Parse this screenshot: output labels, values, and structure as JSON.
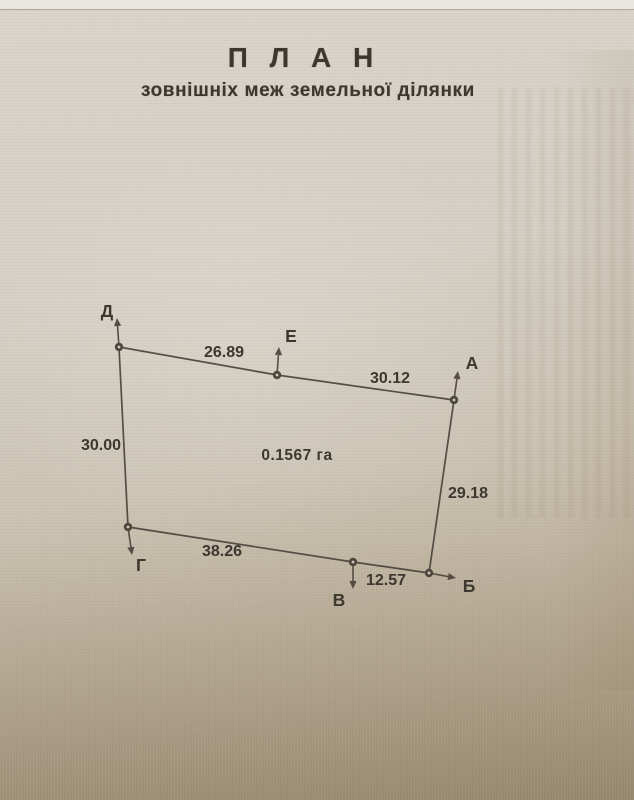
{
  "page": {
    "title": "П Л А Н",
    "subtitle": "зовнішніх меж земельної ділянки"
  },
  "colors": {
    "ink": "#3c372f",
    "line": "#4e473d",
    "paper_top": "#eae7e0",
    "paper_light": "#d9d5cc",
    "paper_mid": "#cbc3b3",
    "paper_dark": "#a29378"
  },
  "plan": {
    "area_label": "0.1567 га",
    "area_pos": {
      "x": 297,
      "y": 460
    },
    "vertices": [
      {
        "name": "Д",
        "x": 119,
        "y": 347,
        "label_x": 107,
        "label_y": 317,
        "arrow_dx": -2,
        "arrow_dy": -29
      },
      {
        "name": "Е",
        "x": 277,
        "y": 375,
        "label_x": 291,
        "label_y": 342,
        "arrow_dx": 2,
        "arrow_dy": -28
      },
      {
        "name": "А",
        "x": 454,
        "y": 400,
        "label_x": 472,
        "label_y": 369,
        "arrow_dx": 4,
        "arrow_dy": -29
      },
      {
        "name": "Б",
        "x": 429,
        "y": 573,
        "label_x": 469,
        "label_y": 592,
        "arrow_dx": 27,
        "arrow_dy": 5
      },
      {
        "name": "В",
        "x": 353,
        "y": 562,
        "label_x": 339,
        "label_y": 606,
        "arrow_dx": 0,
        "arrow_dy": 27
      },
      {
        "name": "Г",
        "x": 128,
        "y": 527,
        "label_x": 141,
        "label_y": 571,
        "arrow_dx": 4,
        "arrow_dy": 28
      }
    ],
    "edges": [
      {
        "from": "Д",
        "to": "Е",
        "label": "26.89",
        "lx": 224,
        "ly": 357
      },
      {
        "from": "Е",
        "to": "А",
        "label": "30.12",
        "lx": 390,
        "ly": 383
      },
      {
        "from": "А",
        "to": "Б",
        "label": "29.18",
        "lx": 468,
        "ly": 498
      },
      {
        "from": "Б",
        "to": "В",
        "label": "12.57",
        "lx": 386,
        "ly": 585
      },
      {
        "from": "В",
        "to": "Г",
        "label": "38.26",
        "lx": 222,
        "ly": 556
      },
      {
        "from": "Г",
        "to": "Д",
        "label": "30.00",
        "lx": 101,
        "ly": 450
      }
    ]
  }
}
